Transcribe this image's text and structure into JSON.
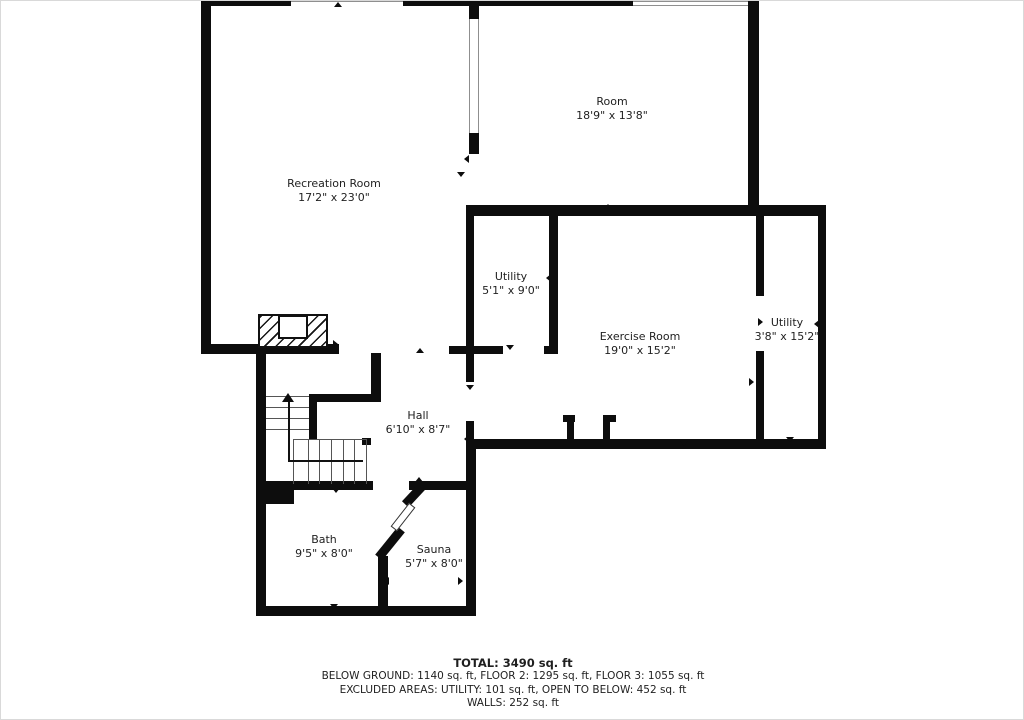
{
  "colors": {
    "wall": "#0d0d0d",
    "text": "#1f1f1f",
    "stair_line": "#555555",
    "window_line": "#8f8f8f"
  },
  "rooms": [
    {
      "id": "recreation-room",
      "name": "Recreation Room",
      "dims": "17'2\" x 23'0\"",
      "cx": 333,
      "top": 176
    },
    {
      "id": "room",
      "name": "Room",
      "dims": "18'9\" x 13'8\"",
      "cx": 611,
      "top": 94
    },
    {
      "id": "utility-1",
      "name": "Utility",
      "dims": "5'1\" x 9'0\"",
      "cx": 510,
      "top": 269
    },
    {
      "id": "exercise-room",
      "name": "Exercise Room",
      "dims": "19'0\" x 15'2\"",
      "cx": 639,
      "top": 329
    },
    {
      "id": "utility-2",
      "name": "Utility",
      "dims": "3'8\" x 15'2\"",
      "cx": 786,
      "top": 315
    },
    {
      "id": "hall",
      "name": "Hall",
      "dims": "6'10\" x 8'7\"",
      "cx": 417,
      "top": 408
    },
    {
      "id": "bath",
      "name": "Bath",
      "dims": "9'5\" x 8'0\"",
      "cx": 323,
      "top": 532
    },
    {
      "id": "sauna",
      "name": "Sauna",
      "dims": "5'7\" x 8'0\"",
      "cx": 433,
      "top": 542
    }
  ],
  "footer": {
    "total": "TOTAL: 3490 sq. ft",
    "floors": "BELOW GROUND: 1140 sq. ft, FLOOR 2: 1295 sq. ft, FLOOR 3: 1055 sq. ft",
    "excluded": "EXCLUDED AREAS: UTILITY: 101 sq. ft, OPEN TO BELOW: 452 sq. ft",
    "walls": "WALLS: 252 sq. ft"
  },
  "floorplan": {
    "walls": [
      [
        200,
        0,
        90,
        5
      ],
      [
        402,
        0,
        230,
        5
      ],
      [
        200,
        0,
        10,
        353
      ],
      [
        747,
        0,
        11,
        215
      ],
      [
        468,
        0,
        10,
        18
      ],
      [
        468,
        132,
        10,
        21
      ],
      [
        465,
        204,
        282,
        11
      ],
      [
        755,
        204,
        70,
        11
      ],
      [
        817,
        204,
        8,
        244
      ],
      [
        465,
        438,
        360,
        10
      ],
      [
        465,
        204,
        8,
        177
      ],
      [
        465,
        420,
        8,
        28
      ],
      [
        465,
        448,
        10,
        167
      ],
      [
        448,
        345,
        54,
        8
      ],
      [
        548,
        204,
        9,
        148
      ],
      [
        543,
        345,
        14,
        8
      ],
      [
        200,
        343,
        138,
        10
      ],
      [
        370,
        352,
        10,
        49
      ],
      [
        308,
        393,
        72,
        8
      ],
      [
        308,
        401,
        8,
        37
      ],
      [
        255,
        345,
        10,
        270
      ],
      [
        255,
        605,
        220,
        10
      ],
      [
        265,
        480,
        107,
        9
      ],
      [
        408,
        480,
        58,
        9
      ],
      [
        265,
        483,
        28,
        20
      ],
      [
        377,
        555,
        10,
        60
      ],
      [
        755,
        215,
        8,
        80
      ],
      [
        755,
        350,
        8,
        88
      ],
      [
        562,
        414,
        12,
        7
      ],
      [
        566,
        414,
        7,
        26
      ],
      [
        602,
        414,
        7,
        26
      ],
      [
        602,
        414,
        13,
        7
      ],
      [
        361,
        437,
        9,
        7
      ]
    ],
    "windows": [
      {
        "x": 290,
        "y": 0,
        "w": 112,
        "h": 5,
        "edges": "t"
      },
      {
        "x": 632,
        "y": 0,
        "w": 115,
        "h": 5,
        "edges": "tb"
      },
      {
        "x": 468,
        "y": 18,
        "w": 10,
        "h": 114,
        "edges": "lr"
      }
    ],
    "markers": [
      [
        337,
        1,
        "u"
      ],
      [
        607,
        203,
        "u"
      ],
      [
        683,
        210,
        "u"
      ],
      [
        789,
        210,
        "u"
      ],
      [
        207,
        170,
        "r"
      ],
      [
        463,
        158,
        "l"
      ],
      [
        460,
        171,
        "d"
      ],
      [
        472,
        277,
        "r"
      ],
      [
        545,
        277,
        "l"
      ],
      [
        509,
        344,
        "d"
      ],
      [
        337,
        343,
        "r"
      ],
      [
        419,
        347,
        "u"
      ],
      [
        469,
        384,
        "d"
      ],
      [
        753,
        381,
        "r"
      ],
      [
        762,
        321,
        "r"
      ],
      [
        813,
        323,
        "l"
      ],
      [
        683,
        440,
        "d"
      ],
      [
        789,
        436,
        "d"
      ],
      [
        463,
        438,
        "l"
      ],
      [
        418,
        476,
        "u"
      ],
      [
        335,
        487,
        "d"
      ],
      [
        333,
        603,
        "d"
      ],
      [
        440,
        605,
        "d"
      ],
      [
        462,
        580,
        "r"
      ],
      [
        383,
        580,
        "l"
      ]
    ],
    "stairs": {
      "hlines": [
        [
          265,
          308,
          395
        ],
        [
          265,
          308,
          406
        ],
        [
          265,
          308,
          417
        ],
        [
          265,
          308,
          428
        ],
        [
          292,
          365,
          438
        ]
      ],
      "vlines": [
        [
          292,
          438,
          483
        ],
        [
          307,
          438,
          483
        ],
        [
          318,
          438,
          483
        ],
        [
          330,
          438,
          483
        ],
        [
          342,
          438,
          483
        ],
        [
          353,
          438,
          483
        ],
        [
          365,
          438,
          483
        ]
      ],
      "arrow": {
        "head": [
          287,
          392
        ],
        "v": [
          287,
          400,
          459
        ],
        "h": [
          287,
          362,
          459
        ]
      }
    },
    "fireplace": {
      "outer": [
        257,
        313,
        70,
        34
      ],
      "inner": [
        277,
        314,
        30,
        24
      ]
    },
    "diagonals": [
      {
        "x": 371,
        "y": 538,
        "w": 36,
        "h": 9,
        "rot": -51,
        "type": "solid"
      },
      {
        "x": 400,
        "y": 489,
        "w": 27,
        "h": 9,
        "rot": -47,
        "type": "solid"
      },
      {
        "x": 387,
        "y": 512,
        "w": 30,
        "h": 8,
        "rot": -52,
        "type": "open"
      }
    ]
  }
}
